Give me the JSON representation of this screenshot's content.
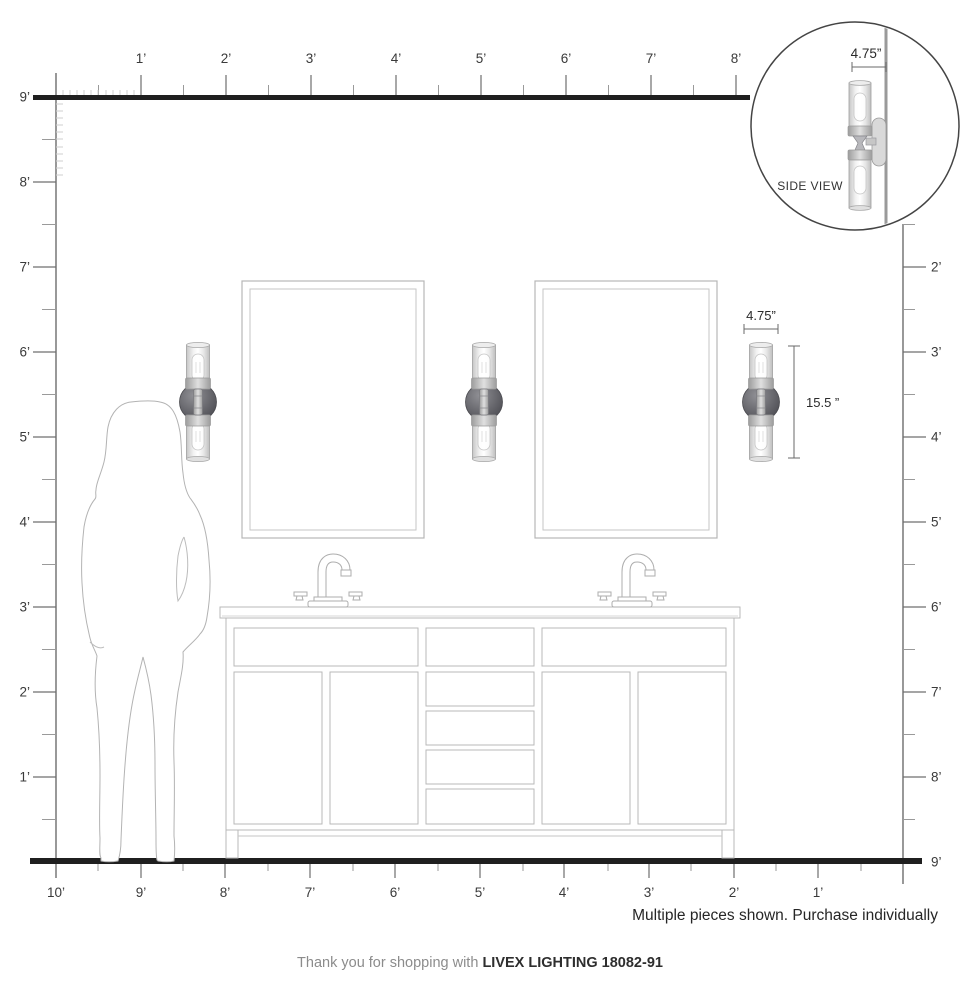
{
  "rulers": {
    "top": {
      "labels": [
        "1’",
        "2’",
        "3’",
        "4’",
        "5’",
        "6’",
        "7’",
        "8’"
      ]
    },
    "left": {
      "labels": [
        "9’",
        "8’",
        "7’",
        "6’",
        "5’",
        "4’",
        "3’",
        "2’",
        "1’"
      ]
    },
    "right": {
      "labels": [
        "2’",
        "3’",
        "4’",
        "5’",
        "6’",
        "7’",
        "8’",
        "9’"
      ]
    },
    "bottom": {
      "labels": [
        "10’",
        "9’",
        "8’",
        "7’",
        "6’",
        "5’",
        "4’",
        "3’",
        "2’",
        "1’"
      ]
    }
  },
  "inset": {
    "width_dim": "4.75”",
    "caption": "SIDE VIEW"
  },
  "sconce_dims": {
    "width": "4.75”",
    "height": "15.5 ”"
  },
  "notes": {
    "purchase": "Multiple pieces shown. Purchase individually"
  },
  "footer": {
    "prefix": "Thank you for shopping with ",
    "brand": "LIVEX LIGHTING 18082-91"
  },
  "colors": {
    "structure_line": "#1f1f1f",
    "line_art": "#b3b3b3",
    "ruler_line": "#555555",
    "label_text": "#3a3a3a",
    "plate_gray": "#55555a"
  }
}
